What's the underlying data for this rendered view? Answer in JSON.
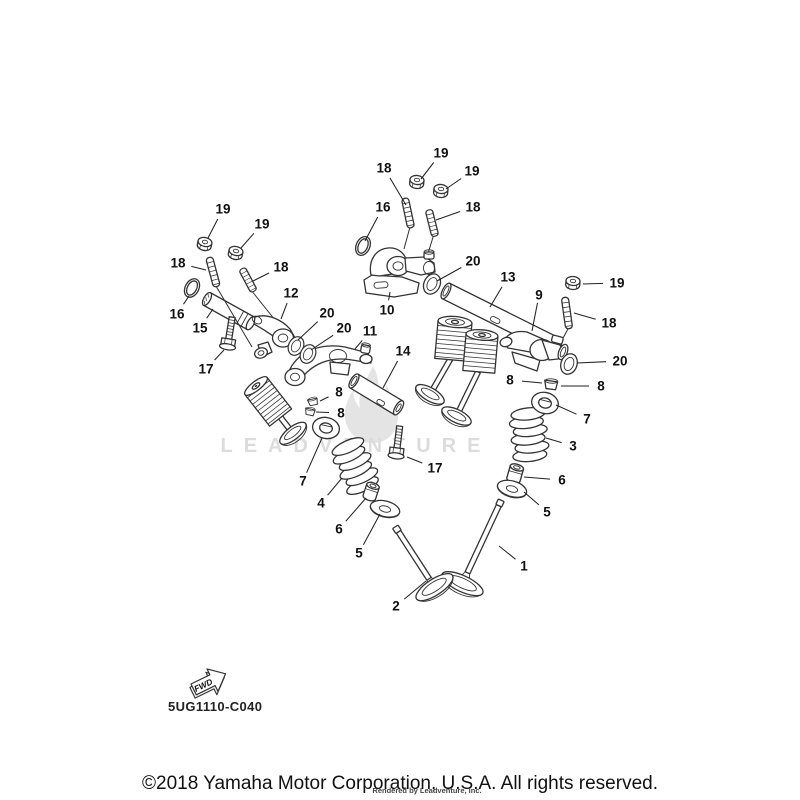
{
  "figure": {
    "code": "5UG1110-C040",
    "fwd_label": "FWD",
    "watermark": {
      "text": "LEADVENTURE"
    },
    "footer": {
      "copyright": "©2018 Yamaha Motor Corporation, U.S.A. All rights reserved.",
      "rendered_by": "Rendered by Leadventure, Inc."
    },
    "ink_color": "#333333",
    "text_color": "#111111",
    "callouts": [
      {
        "label": "18",
        "tx": 384,
        "ty": 168,
        "lx": 406,
        "ly": 205
      },
      {
        "label": "19",
        "tx": 441,
        "ty": 153,
        "lx": 421,
        "ly": 179
      },
      {
        "label": "19",
        "tx": 472,
        "ty": 171,
        "lx": 446,
        "ly": 189
      },
      {
        "label": "16",
        "tx": 383,
        "ty": 207,
        "lx": 365,
        "ly": 241
      },
      {
        "label": "18",
        "tx": 473,
        "ty": 207,
        "lx": 436,
        "ly": 220
      },
      {
        "label": "20",
        "tx": 473,
        "ty": 261,
        "lx": 437,
        "ly": 281
      },
      {
        "label": "10",
        "tx": 387,
        "ty": 310,
        "lx": 390,
        "ly": 292
      },
      {
        "label": "13",
        "tx": 508,
        "ty": 277,
        "lx": 490,
        "ly": 307
      },
      {
        "label": "9",
        "tx": 539,
        "ty": 295,
        "lx": 532,
        "ly": 331
      },
      {
        "label": "19",
        "tx": 617,
        "ty": 283,
        "lx": 583,
        "ly": 284
      },
      {
        "label": "18",
        "tx": 609,
        "ty": 323,
        "lx": 574,
        "ly": 313
      },
      {
        "label": "20",
        "tx": 620,
        "ty": 361,
        "lx": 577,
        "ly": 363
      },
      {
        "label": "19",
        "tx": 223,
        "ty": 209,
        "lx": 208,
        "ly": 238
      },
      {
        "label": "19",
        "tx": 262,
        "ty": 224,
        "lx": 241,
        "ly": 248
      },
      {
        "label": "18",
        "tx": 178,
        "ty": 263,
        "lx": 206,
        "ly": 270
      },
      {
        "label": "18",
        "tx": 281,
        "ty": 267,
        "lx": 253,
        "ly": 281
      },
      {
        "label": "16",
        "tx": 177,
        "ty": 314,
        "lx": 189,
        "ly": 296
      },
      {
        "label": "15",
        "tx": 200,
        "ty": 328,
        "lx": 213,
        "ly": 309
      },
      {
        "label": "12",
        "tx": 291,
        "ty": 293,
        "lx": 281,
        "ly": 319
      },
      {
        "label": "20",
        "tx": 327,
        "ty": 313,
        "lx": 298,
        "ly": 340
      },
      {
        "label": "20",
        "tx": 344,
        "ty": 328,
        "lx": 311,
        "ly": 350
      },
      {
        "label": "11",
        "tx": 370,
        "ty": 331,
        "lx": 355,
        "ly": 349
      },
      {
        "label": "17",
        "tx": 206,
        "ty": 369,
        "lx": 224,
        "ly": 350
      },
      {
        "label": "14",
        "tx": 403,
        "ty": 351,
        "lx": 383,
        "ly": 388
      },
      {
        "label": "8",
        "tx": 339,
        "ty": 392,
        "lx": 320,
        "ly": 401
      },
      {
        "label": "8",
        "tx": 341,
        "ty": 413,
        "lx": 316,
        "ly": 412
      },
      {
        "label": "7",
        "tx": 303,
        "ty": 481,
        "lx": 322,
        "ly": 438
      },
      {
        "label": "4",
        "tx": 321,
        "ty": 503,
        "lx": 342,
        "ly": 478
      },
      {
        "label": "17",
        "tx": 435,
        "ty": 468,
        "lx": 407,
        "ly": 457
      },
      {
        "label": "6",
        "tx": 339,
        "ty": 529,
        "lx": 366,
        "ly": 498
      },
      {
        "label": "5",
        "tx": 359,
        "ty": 553,
        "lx": 380,
        "ly": 514
      },
      {
        "label": "2",
        "tx": 396,
        "ty": 606,
        "lx": 426,
        "ly": 581
      },
      {
        "label": "8",
        "tx": 510,
        "ty": 380,
        "lx": 542,
        "ly": 383
      },
      {
        "label": "8",
        "tx": 601,
        "ty": 386,
        "lx": 561,
        "ly": 386
      },
      {
        "label": "7",
        "tx": 587,
        "ty": 419,
        "lx": 556,
        "ly": 405
      },
      {
        "label": "3",
        "tx": 573,
        "ty": 446,
        "lx": 546,
        "ly": 438
      },
      {
        "label": "6",
        "tx": 562,
        "ty": 480,
        "lx": 524,
        "ly": 477
      },
      {
        "label": "5",
        "tx": 547,
        "ty": 512,
        "lx": 524,
        "ly": 492
      },
      {
        "label": "1",
        "tx": 524,
        "ty": 566,
        "lx": 499,
        "ly": 546
      }
    ]
  }
}
